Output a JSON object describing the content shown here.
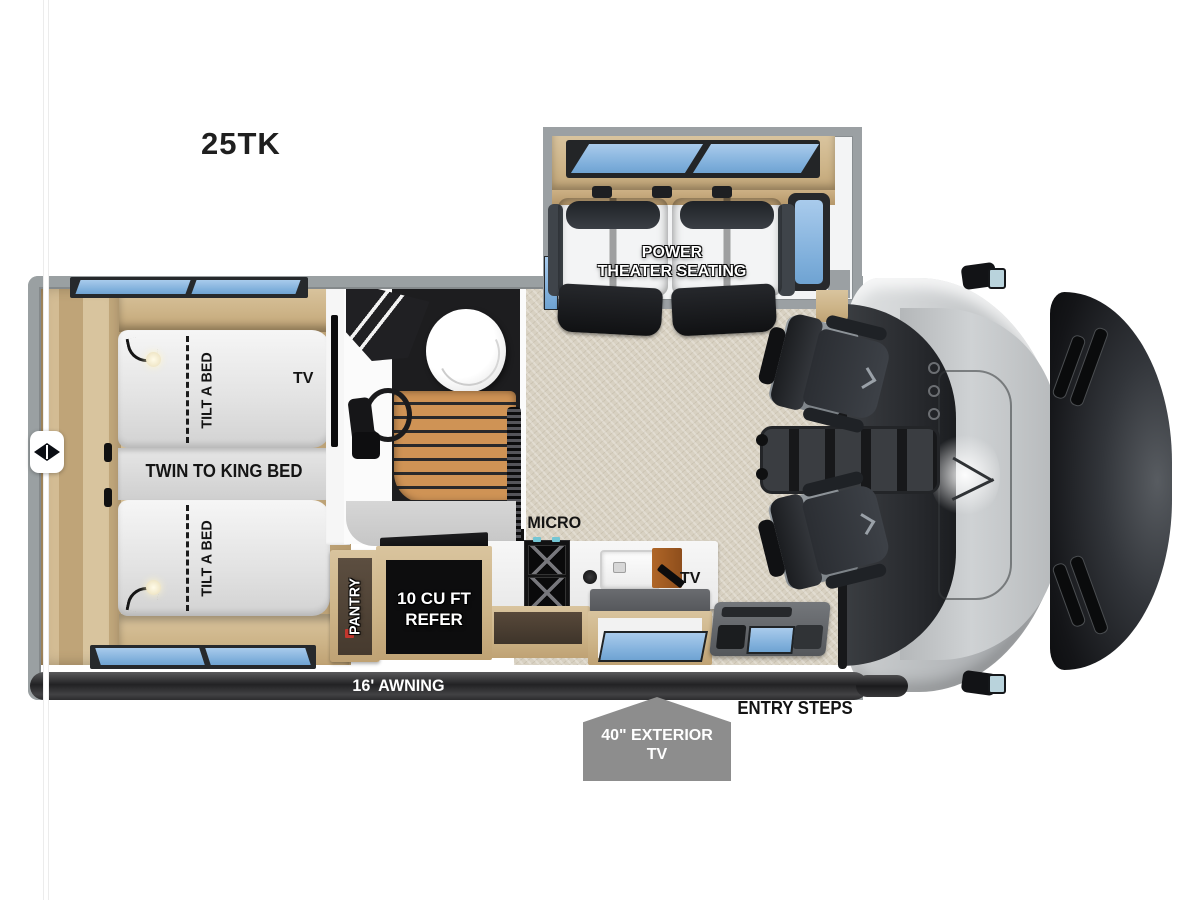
{
  "title": "25TK",
  "floorplan": {
    "slideout": {
      "label_line1": "POWER",
      "label_line2": "THEATER SEATING"
    },
    "bedroom": {
      "bed_center_label": "TWIN TO KING BED",
      "bed_top_label": "TILT A BED",
      "bed_bottom_label": "TILT A BED",
      "tv_label": "TV"
    },
    "bathroom": {},
    "kitchen": {
      "micro_label": "MICRO",
      "tv_label": "TV",
      "pantry_label": "PANTRY",
      "refer_label_line1": "10 CU FT",
      "refer_label_line2": "REFER"
    },
    "exterior": {
      "awning_label": "16' AWNING",
      "entry_steps_label": "ENTRY STEPS",
      "exterior_tv_line1": "40\" EXTERIOR",
      "exterior_tv_line2": "TV"
    }
  },
  "colors": {
    "window_glass": "#7db4dc",
    "wood": "#d5bf9a",
    "carpet": "#d8d1c2",
    "body_gray": "#9aa0a2",
    "seat_charcoal": "#3b4046",
    "badge_gray": "#8d8d8d",
    "pantry_accent_red": "#c2372e",
    "hood_black": "#141518"
  }
}
